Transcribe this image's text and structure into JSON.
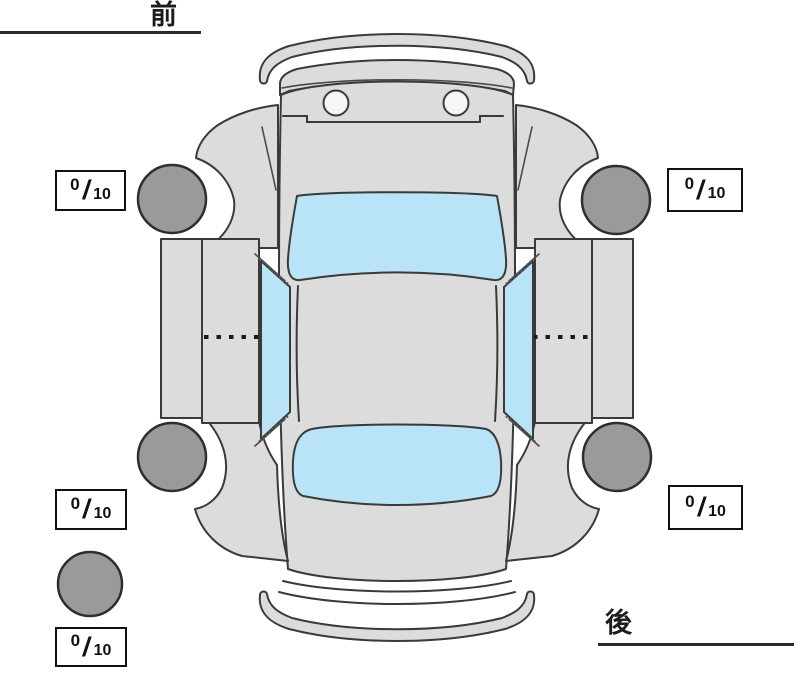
{
  "labels": {
    "front": "前",
    "rear": "後"
  },
  "separator": "/",
  "tread_gauges": [
    {
      "id": "front-left",
      "value": "0",
      "max": "10"
    },
    {
      "id": "front-right",
      "value": "0",
      "max": "10"
    },
    {
      "id": "rear-left",
      "value": "0",
      "max": "10"
    },
    {
      "id": "rear-right",
      "value": "0",
      "max": "10"
    },
    {
      "id": "spare",
      "value": "0",
      "max": "10"
    }
  ],
  "colors": {
    "body_panel": "#dcdcdc",
    "glass": "#b9e3f6",
    "tire": "#9a9a9a",
    "outline": "#3a3a3a",
    "box_border": "#111111",
    "background": "#ffffff"
  }
}
